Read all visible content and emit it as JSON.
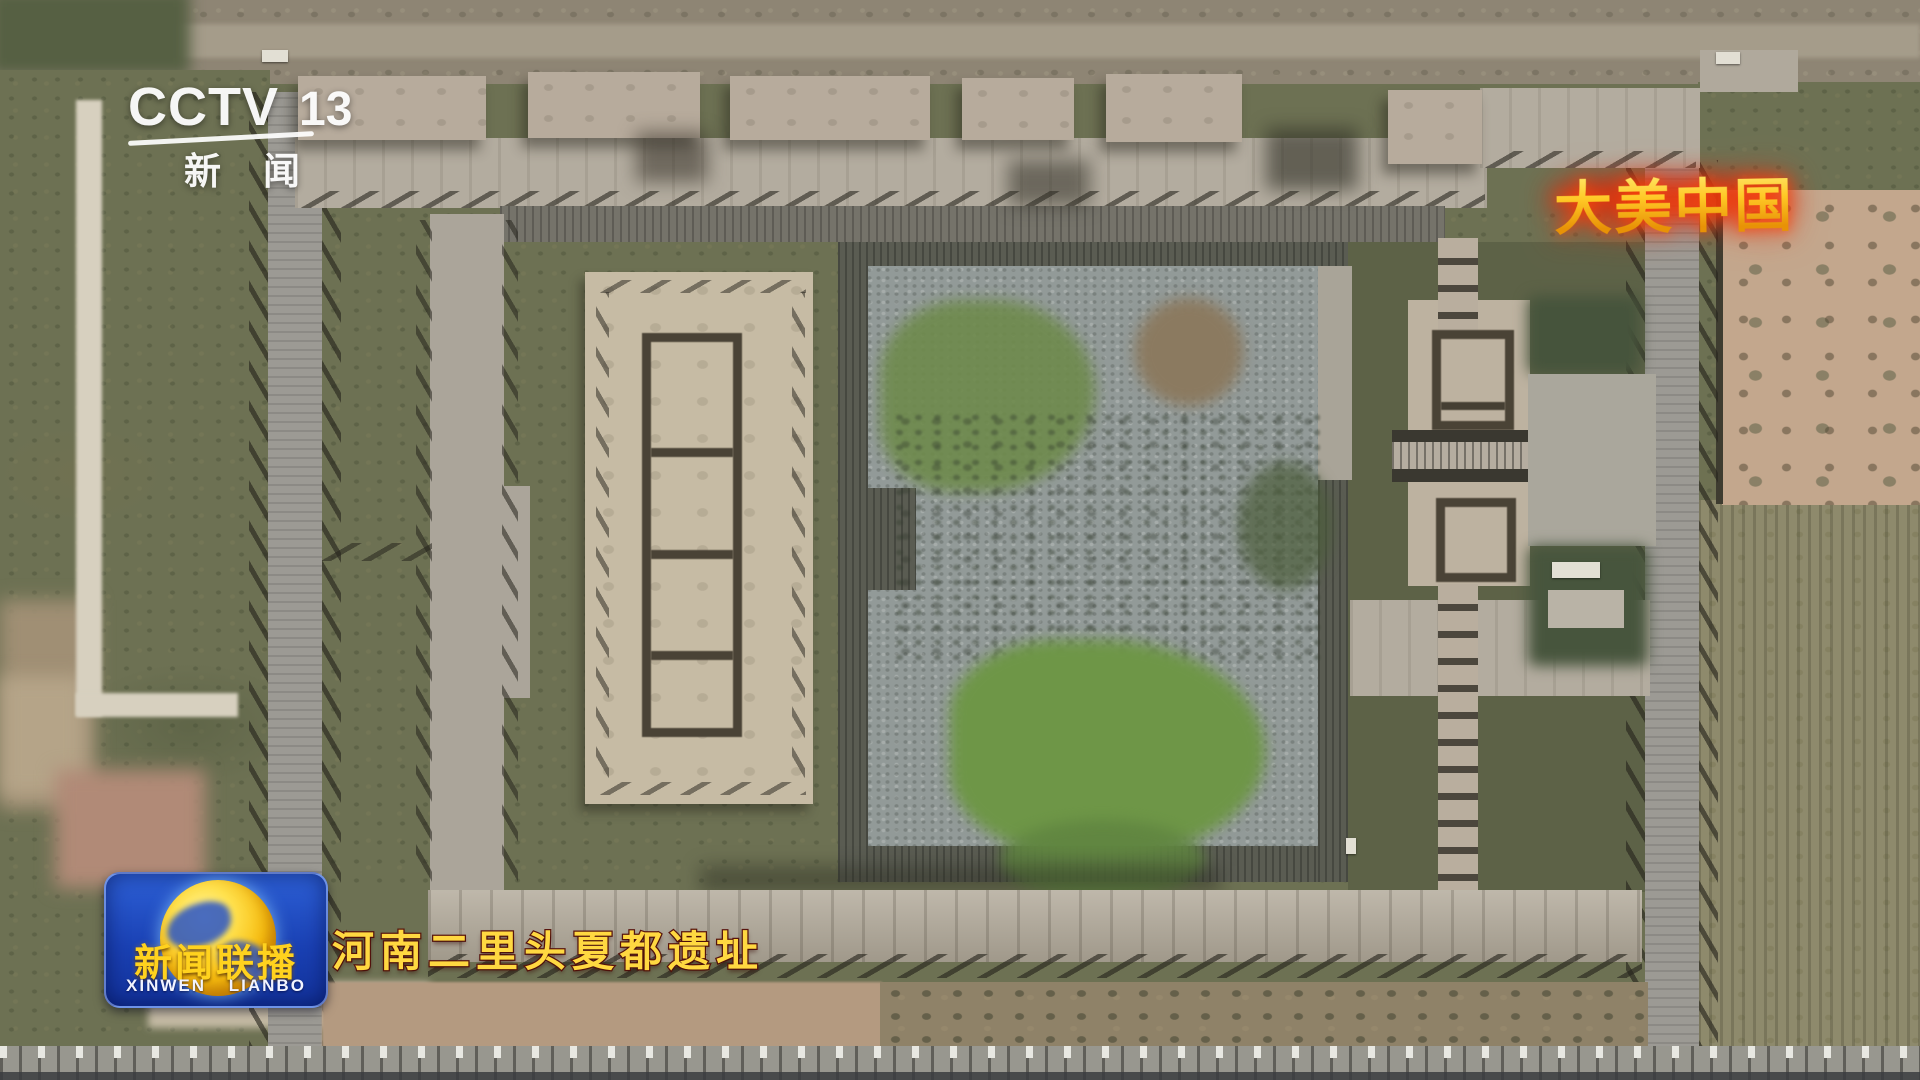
{
  "channel_bug": {
    "name": "CCTV",
    "number": "13",
    "subtitle": "新闻"
  },
  "corner_badge": {
    "text": "大美中国"
  },
  "program_logo": {
    "title": "新闻联播",
    "subtitle": "XINWEN LIANBO"
  },
  "caption": {
    "text": "河南二里头夏都遗址"
  },
  "colors": {
    "badge_gold": "#ffc825",
    "badge_glow": "#d8270b",
    "caption_yellow": "#ffd841",
    "caption_outline": "#5a150e",
    "logo_blue": "#1a41b4",
    "logo_yellow": "#ffd21e",
    "walkway_light": "#b3ac9f",
    "gravel": "#929a98",
    "vegetation": "#6e9647"
  }
}
